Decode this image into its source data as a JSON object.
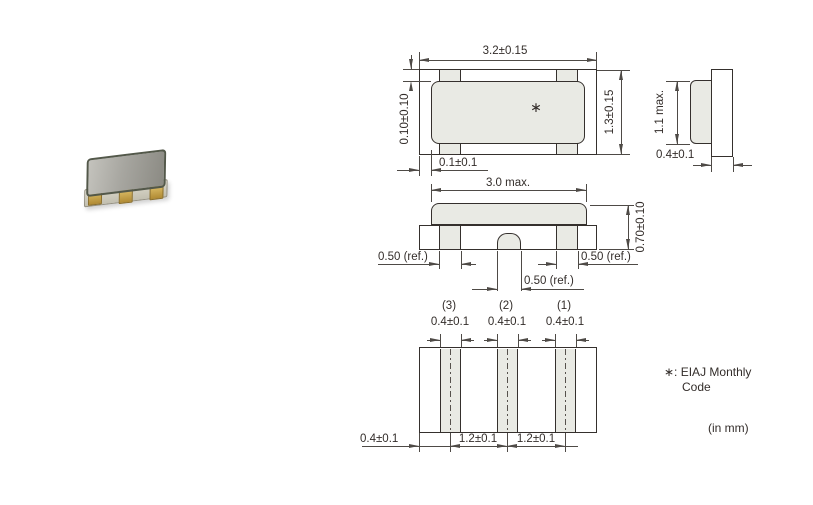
{
  "component": {
    "marking_symbol": "∗"
  },
  "top_view": {
    "dim_width": "3.2±0.15",
    "dim_height": "1.3±0.15",
    "dim_lid_gap_top": "0.10±0.10",
    "dim_lid_gap_left": "0.1±0.1"
  },
  "side_view": {
    "dim_height": "1.1 max.",
    "dim_base_thickness": "0.4±0.1"
  },
  "front_view": {
    "dim_lid_width": "3.0 max.",
    "dim_total_height": "0.70±0.10",
    "dim_terminal_left": "0.50 (ref.)",
    "dim_terminal_right": "0.50 (ref.)",
    "dim_terminal_center": "0.50 (ref.)"
  },
  "terminals": {
    "t3": "(3)",
    "t2": "(2)",
    "t1": "(1)"
  },
  "bottom_view": {
    "dim_pad3_width": "0.4±0.1",
    "dim_pad2_width": "0.4±0.1",
    "dim_pad1_width": "0.4±0.1",
    "dim_edge_to_center": "0.4±0.1",
    "dim_pitch_32": "1.2±0.1",
    "dim_pitch_21": "1.2±0.1"
  },
  "notes": {
    "marking_note": "∗: EIAJ Monthly",
    "marking_note_cont": "Code",
    "units": "(in mm)"
  }
}
